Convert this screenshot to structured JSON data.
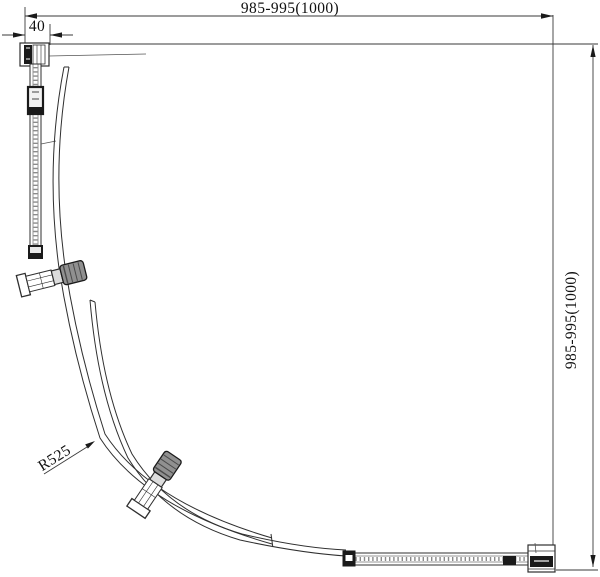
{
  "drawing": {
    "type": "technical-plan-drawing",
    "subject": "quadrant shower enclosure plan view",
    "dimensions": {
      "top_width": "985-995(1000)",
      "right_height": "985-995(1000)",
      "wall_profile_width": "40",
      "door_radius": "R525"
    },
    "colors": {
      "background": "#ffffff",
      "line": "#2f2f2f",
      "dim_line": "#3a3a3a",
      "glass_hatch": "#8a8a8a",
      "knob_fill": "#909090",
      "knob_hatch": "#4a4a4a",
      "black_part": "#1a1a1a"
    }
  }
}
